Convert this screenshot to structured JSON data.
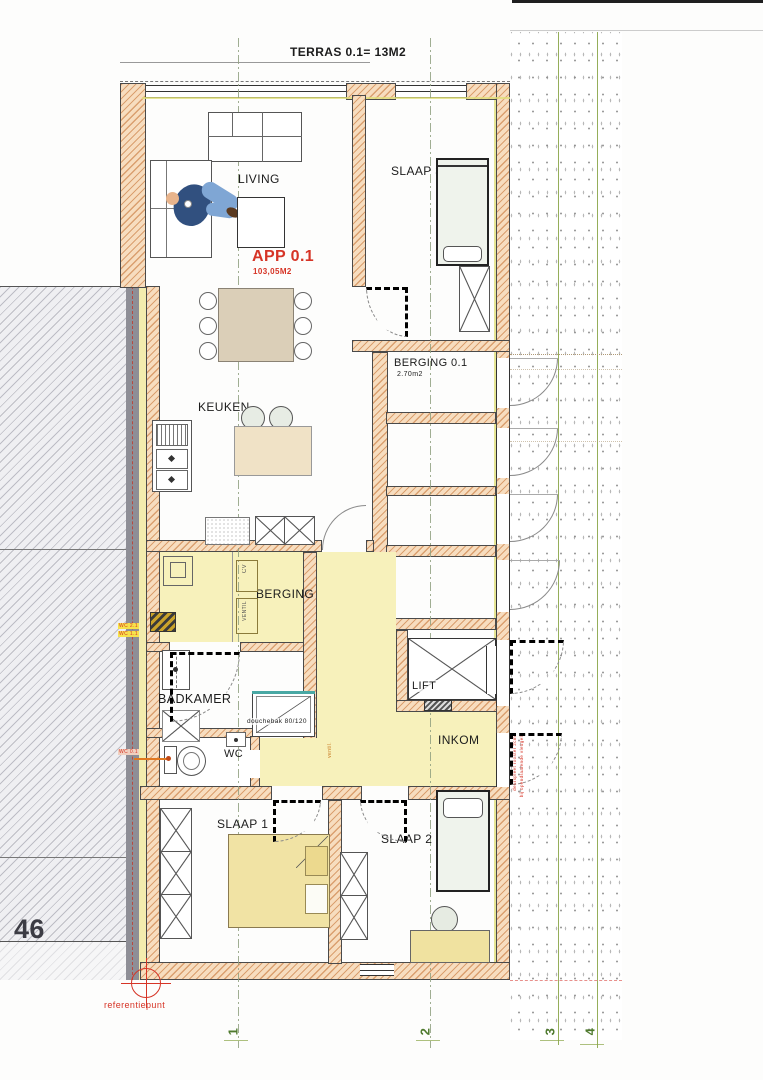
{
  "terras": "TERRAS 0.1=  13M2",
  "app": {
    "name": "APP 0.1",
    "area": "103,05M2"
  },
  "rooms": {
    "living": "LIVING",
    "slaap3": "SLAAP 3",
    "berging01": "BERGING 0.1",
    "berging01_area": "2.70m2",
    "keuken": "KEUKEN",
    "berging": "BERGING",
    "badkamer": "BADKAMER",
    "wc": "WC",
    "lift": "LIFT",
    "inkom": "INKOM",
    "slaap1": "SLAAP 1",
    "slaap2": "SLAAP 2"
  },
  "annotations": {
    "douchebak": "douchebak 80/120",
    "cv": "CV",
    "ventil": "VENTIL",
    "hall_note": "ventil.",
    "referentiepunt": "referentiepunt",
    "parcel": "46",
    "wc21": "WC 2.1",
    "wc11": "WC 1.1",
    "wc01": "WC 0.1",
    "door_note1": "deurspleet rooster 2cm",
    "door_note2": "bij opendraaiende vleugel"
  },
  "grid": {
    "g1": "1",
    "g2": "2",
    "g3": "3",
    "g4": "4"
  },
  "colors": {
    "wall_hatch": "#c8763a",
    "accent_red": "#d63426",
    "grid_green": "#8aa548",
    "room_yellow": "#f7f1bb"
  }
}
